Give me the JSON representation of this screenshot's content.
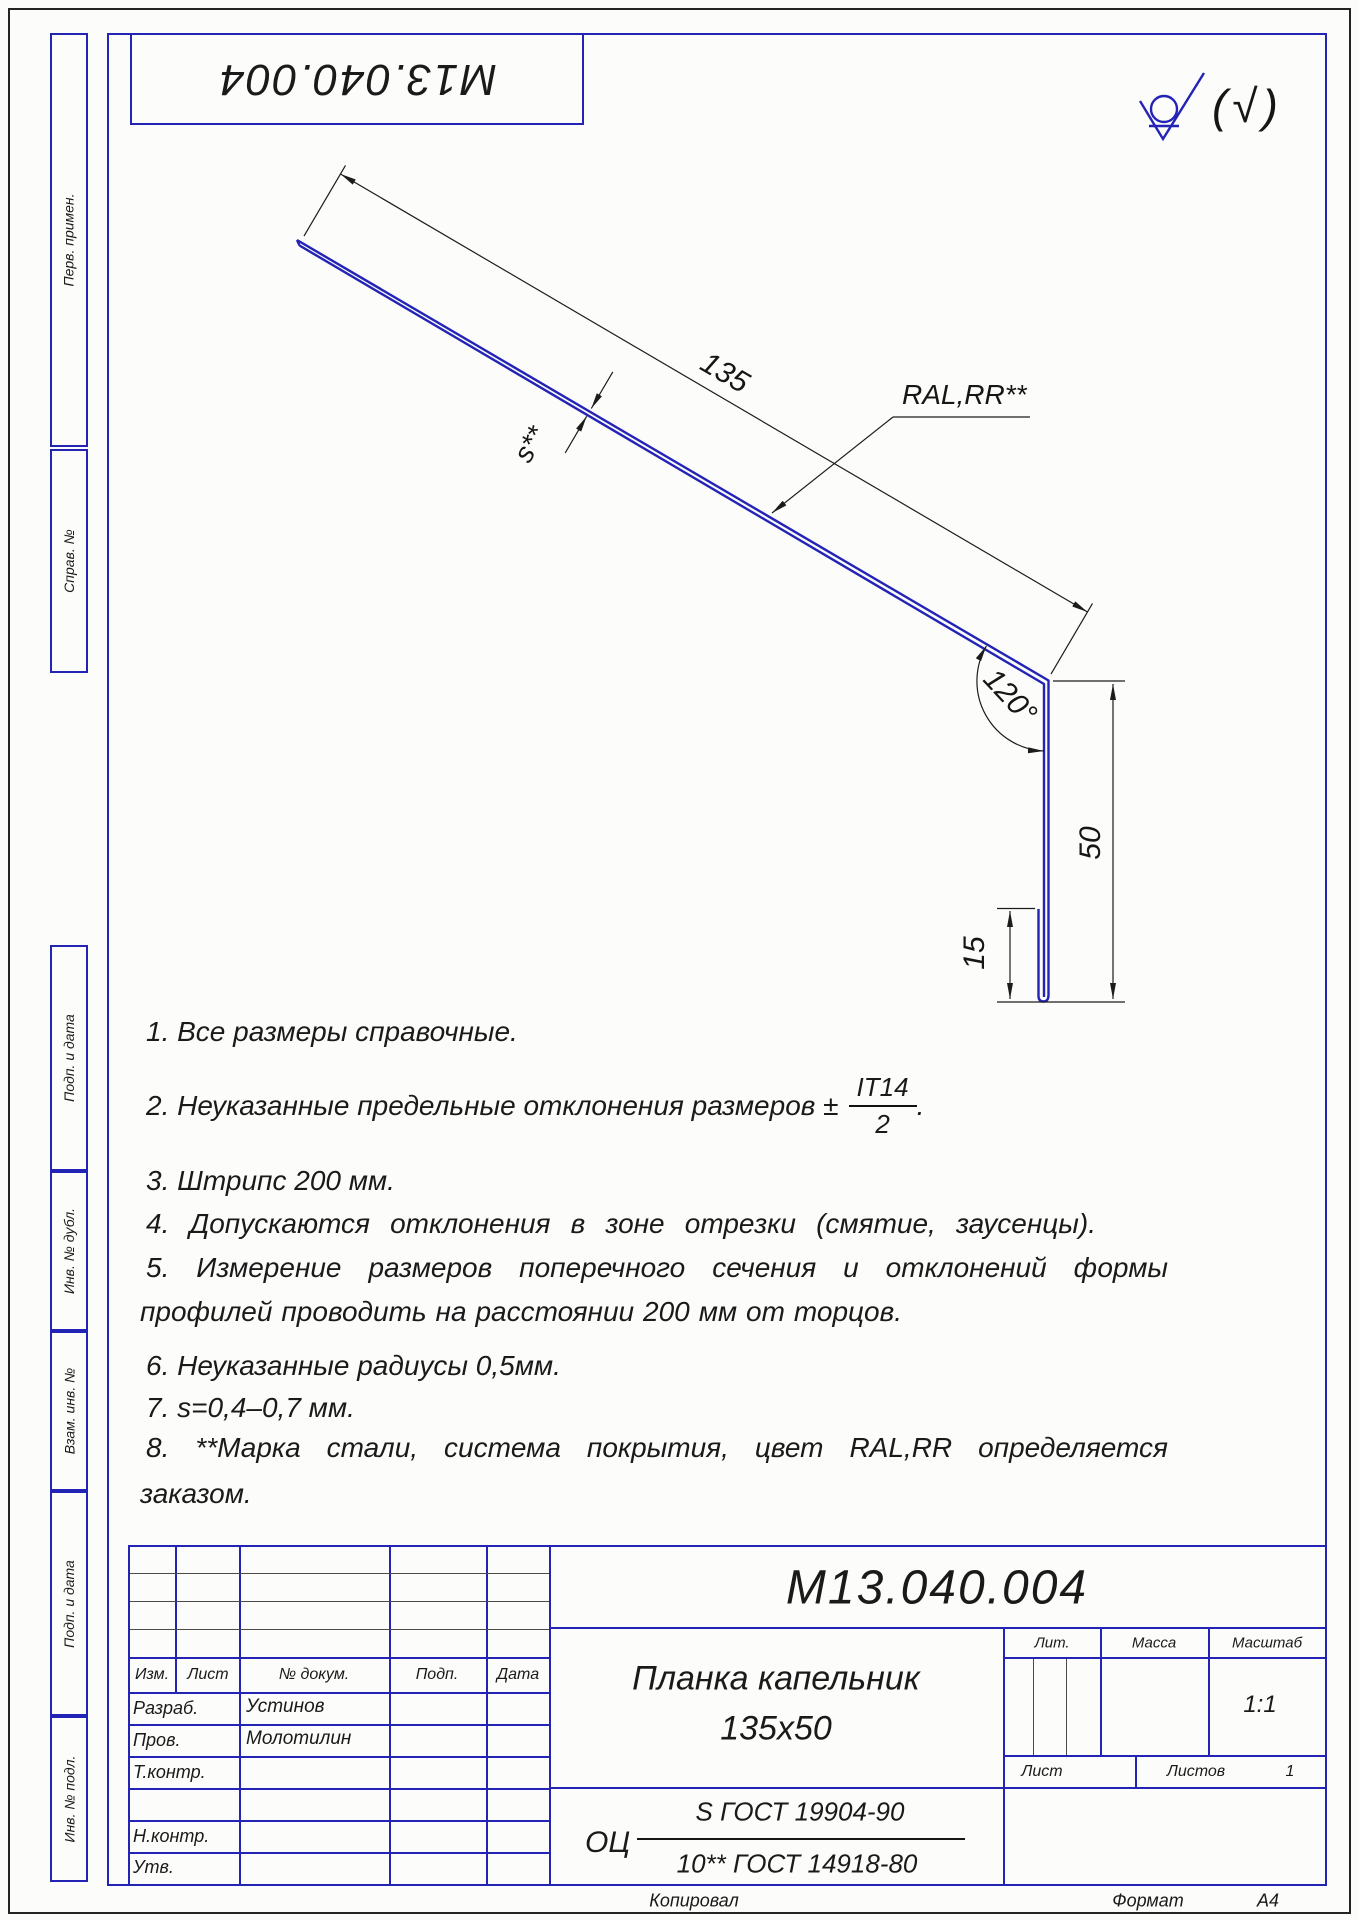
{
  "page": {
    "top_doc_number": "М13.040.004",
    "roughness_paren": "(√)"
  },
  "left_margin": {
    "perv_primen": "Перв. примен.",
    "sprav_no": "Справ. №",
    "podp_data_1": "Подп. и дата",
    "inv_dubl": "Инв. № дубл.",
    "vzam_inv": "Взам. инв. №",
    "podp_data_2": "Подп. и дата",
    "inv_podl": "Инв. № подл."
  },
  "drawing": {
    "dim_length": "135",
    "dim_thickness": "s**",
    "coating_label": "RAL,RR**",
    "dim_angle": "120°",
    "dim_height": "50",
    "dim_hem": "15"
  },
  "notes": {
    "n1": "1.  Все размеры справочные.",
    "n2_pre": "2.  Неуказанные предельные отклонения размеров ±",
    "n2_frac_num": "IT14",
    "n2_frac_den": "2",
    "n2_post": ".",
    "n3": "3.  Штрипс 200 мм.",
    "n4": "4.  Допускаются отклонения в зоне отрезки (смятие, заусенцы).",
    "n5a": "5.  Измерение размеров поперечного сечения и отклонений формы",
    "n5b": "профилей проводить на расстоянии 200 мм от торцов.",
    "n6": "6.  Неуказанные  радиусы 0,5мм.",
    "n7": "7.  s=0,4–0,7 мм.",
    "n8a": "8.  **Марка стали, система покрытия, цвет RAL,RR определяется",
    "n8b": "заказом."
  },
  "title_block": {
    "doc_number": "М13.040.004",
    "name_line1": "Планка капельник",
    "name_line2": "135х50",
    "material_prefix": "ОЦ",
    "material_num": "S ГОСТ 19904-90",
    "material_den": "10** ГОСТ 14918-80",
    "col_izm": "Изм.",
    "col_list": "Лист",
    "col_dokum": "№ докум.",
    "col_podp": "Подп.",
    "col_data": "Дата",
    "row_razrab": "Разраб.",
    "row_razrab_val": "Устинов",
    "row_prov": "Пров.",
    "row_prov_val": "Молотилин",
    "row_tkontr": "Т.контр.",
    "row_nkontr": "Н.контр.",
    "row_utv": "Утв.",
    "lit_label": "Лит.",
    "massa_label": "Масса",
    "masshtab_label": "Масштаб",
    "masshtab_value": "1:1",
    "list_label": "Лист",
    "listov_label": "Листов",
    "listov_value": "1"
  },
  "footer": {
    "kopiroval": "Копировал",
    "format_label": "Формат",
    "format_value": "А4"
  }
}
